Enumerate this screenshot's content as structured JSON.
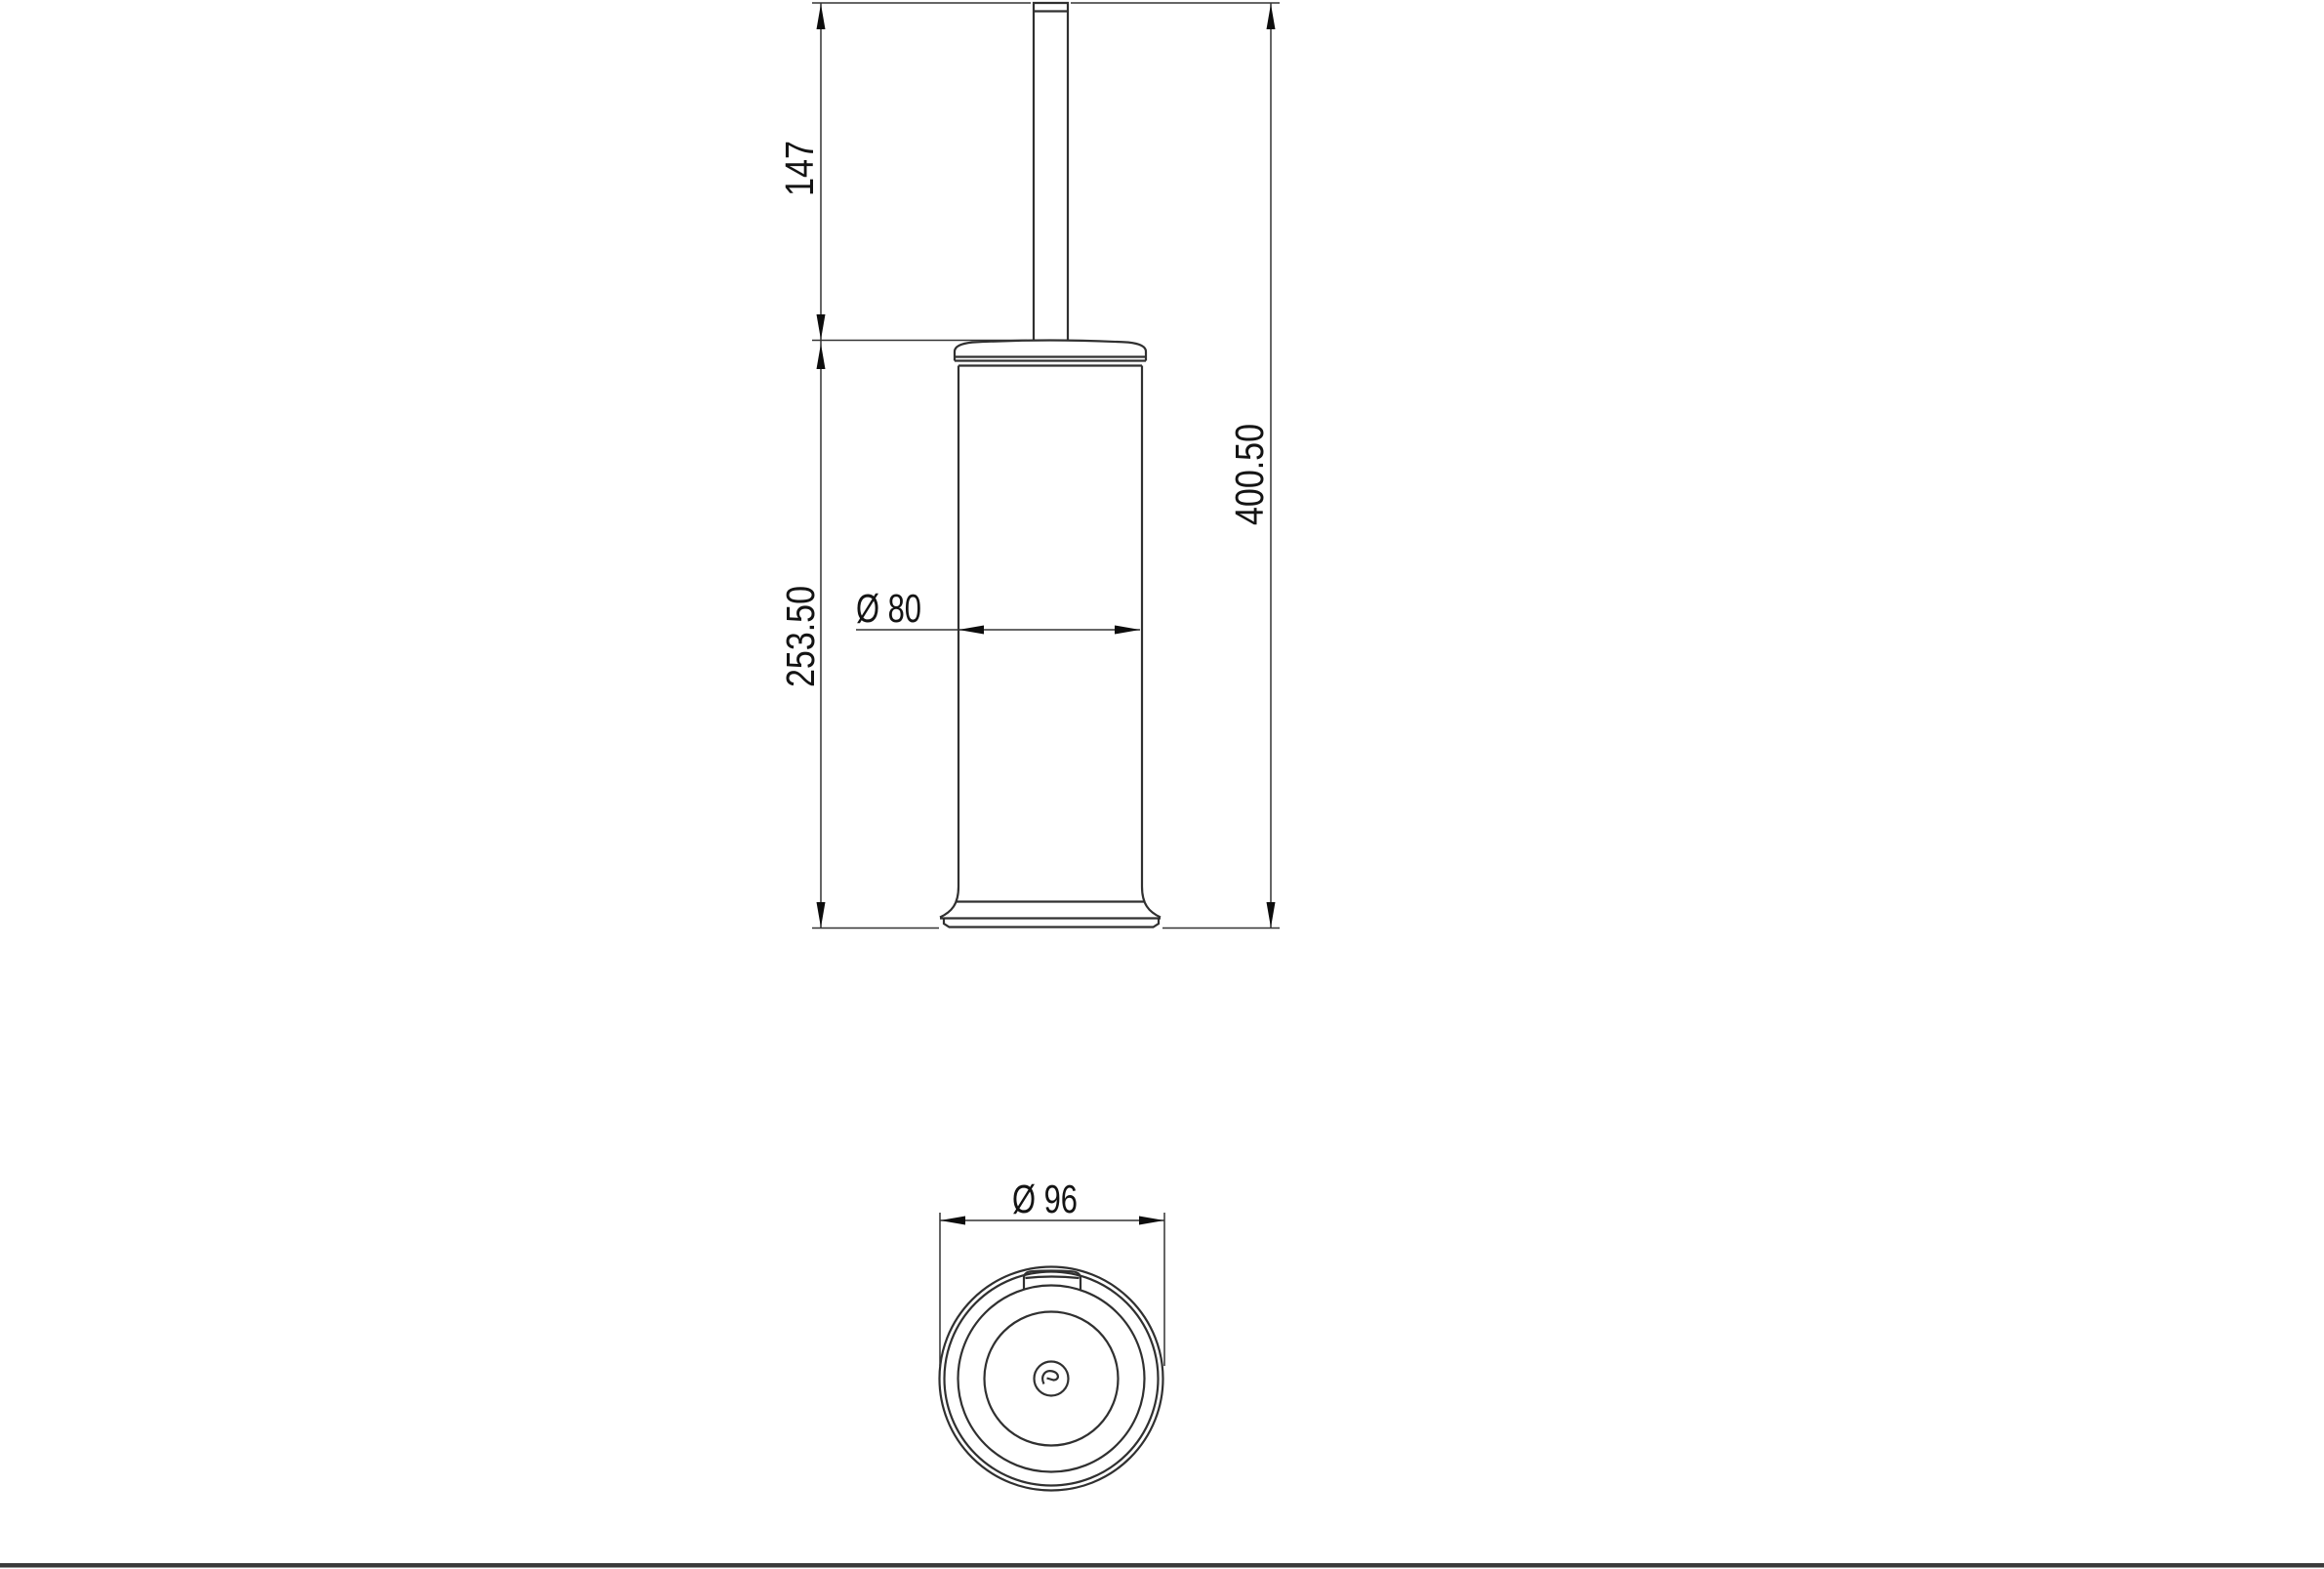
{
  "drawing": {
    "type": "technical-drawing",
    "subject": "toilet-brush-holder",
    "dimensions": {
      "handle_height": {
        "label": "147",
        "value": 147,
        "orientation": "vertical"
      },
      "container_height": {
        "label": "253.50",
        "value": 253.5,
        "orientation": "vertical"
      },
      "total_height": {
        "label": "400.50",
        "value": 400.5,
        "orientation": "vertical"
      },
      "body_diameter": {
        "label": "Ø 80",
        "value": 80,
        "orientation": "horizontal"
      },
      "outer_diameter": {
        "label": "Ø 96",
        "value": 96,
        "orientation": "horizontal"
      }
    },
    "colors": {
      "background": "#ffffff",
      "line": "#303030",
      "dimension_line": "#343434",
      "text": "#141414",
      "bottom_border": "#3b3b3b"
    }
  }
}
